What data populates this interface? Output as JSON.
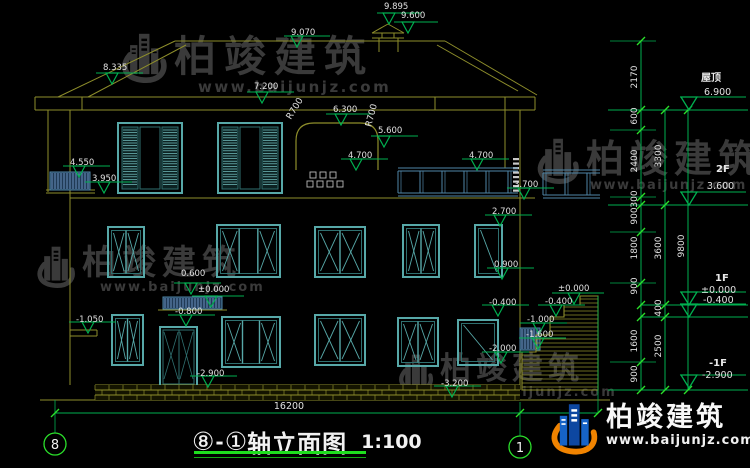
{
  "page": {
    "background": "#000000"
  },
  "colors": {
    "outline": "#8e8e2b",
    "window": "#57a8a8",
    "window_dim": "#2f6f6f",
    "railing": "#4f86a8",
    "hatch_fill": "#203a55",
    "hatch_stripe": "#7aa6d8",
    "dimension": "#00b050",
    "tick": "#2be02b",
    "underline": "#1ede1e",
    "text": "#e0e0e0",
    "watermark": "#3a3a3a",
    "logo_blue": "#1663c7",
    "logo_blue_dark": "#0d47a1",
    "logo_orange": "#f08300"
  },
  "brand": {
    "name": "柏竣建筑",
    "url": "www.baijunjz.com"
  },
  "title_block": {
    "axis_from": "⑧",
    "separator": "-",
    "axis_to": "①",
    "name": "轴立面图",
    "scale": "1:100"
  },
  "axis_bubbles": {
    "left": "8",
    "right": "1"
  },
  "overall_dimension": "16200",
  "elevation_markers": [
    {
      "t": "9.895",
      "x": 384,
      "y": 9,
      "tipx": 389,
      "tipy": 24,
      "l1": 377,
      "l2": 421
    },
    {
      "t": "9.600",
      "x": 401,
      "y": 18,
      "tipx": 408,
      "tipy": 33,
      "l1": 394,
      "l2": 438
    },
    {
      "t": "9.070",
      "x": 291,
      "y": 35,
      "tipx": 297,
      "tipy": 47,
      "l1": 284,
      "l2": 330
    },
    {
      "t": "8.335",
      "x": 103,
      "y": 70,
      "tipx": 112,
      "tipy": 84,
      "l1": 96,
      "l2": 143
    },
    {
      "t": "7.200",
      "x": 254,
      "y": 89,
      "tipx": 262,
      "tipy": 103,
      "l1": 247,
      "l2": 294
    },
    {
      "t": "6.300",
      "x": 333,
      "y": 112,
      "tipx": 341,
      "tipy": 125,
      "l1": 326,
      "l2": 373
    },
    {
      "t": "5.600",
      "x": 378,
      "y": 133,
      "tipx": 384,
      "tipy": 147,
      "l1": 371,
      "l2": 418
    },
    {
      "t": "4.700",
      "x": 348,
      "y": 158,
      "tipx": 356,
      "tipy": 170,
      "l1": 341,
      "l2": 388
    },
    {
      "t": "4.700",
      "x": 469,
      "y": 158,
      "tipx": 477,
      "tipy": 170,
      "l1": 462,
      "l2": 509
    },
    {
      "t": "4.550",
      "x": 70,
      "y": 165,
      "tipx": 79,
      "tipy": 177,
      "l1": 63,
      "l2": 110
    },
    {
      "t": "3.950",
      "x": 92,
      "y": 181,
      "tipx": 104,
      "tipy": 193,
      "l1": 85,
      "l2": 132
    },
    {
      "t": "3.700",
      "x": 514,
      "y": 187,
      "tipx": 524,
      "tipy": 199,
      "l1": 507,
      "l2": 554
    },
    {
      "t": "2.700",
      "x": 492,
      "y": 214,
      "tipx": 500,
      "tipy": 226,
      "l1": 485,
      "l2": 532
    },
    {
      "t": "0.900",
      "x": 494,
      "y": 267,
      "tipx": 502,
      "tipy": 279,
      "l1": 487,
      "l2": 534
    },
    {
      "t": "0.600",
      "x": 181,
      "y": 276,
      "tipx": 191,
      "tipy": 294,
      "l1": 174,
      "l2": 221
    },
    {
      "t": "±0.000",
      "x": 198,
      "y": 292,
      "tipx": 211,
      "tipy": 307,
      "l1": 192,
      "l2": 244
    },
    {
      "t": "-0.800",
      "x": 175,
      "y": 314,
      "tipx": 186,
      "tipy": 326,
      "l1": 168,
      "l2": 215
    },
    {
      "t": "-1.050",
      "x": 76,
      "y": 322,
      "tipx": 88,
      "tipy": 333,
      "l1": 69,
      "l2": 116
    },
    {
      "t": "-2.900",
      "x": 197,
      "y": 376,
      "tipx": 208,
      "tipy": 387,
      "l1": 190,
      "l2": 237
    },
    {
      "t": "-0.400",
      "x": 489,
      "y": 305,
      "tipx": 498,
      "tipy": 316,
      "l1": 482,
      "l2": 529
    },
    {
      "t": "±0.000",
      "x": 558,
      "y": 291,
      "tipx": 574,
      "tipy": 304,
      "l1": 552,
      "l2": 604
    },
    {
      "t": "-0.400",
      "x": 545,
      "y": 304,
      "tipx": 556,
      "tipy": 316,
      "l1": 538,
      "l2": 585
    },
    {
      "t": "-1.000",
      "x": 527,
      "y": 322,
      "tipx": 539,
      "tipy": 334,
      "l1": 520,
      "l2": 567
    },
    {
      "t": "-1.600",
      "x": 526,
      "y": 337,
      "tipx": 538,
      "tipy": 349,
      "l1": 519,
      "l2": 566
    },
    {
      "t": "-2.000",
      "x": 489,
      "y": 351,
      "tipx": 501,
      "tipy": 363,
      "l1": 482,
      "l2": 529
    },
    {
      "t": "-3.200",
      "x": 441,
      "y": 386,
      "tipx": 452,
      "tipy": 397,
      "l1": 434,
      "l2": 481
    }
  ],
  "right_levels": [
    {
      "label": "屋顶",
      "lx": 701,
      "ly": 81,
      "value": "6.900",
      "vx": 704,
      "vy": 95,
      "tipy": 110
    },
    {
      "label": "2F",
      "lx": 716,
      "ly": 172,
      "value": "3.600",
      "vx": 707,
      "vy": 189,
      "tipy": 205
    },
    {
      "label": "1F",
      "lx": 715,
      "ly": 281,
      "value": "±0.000",
      "vx": 701,
      "vy": 293,
      "tipy": 305
    },
    {
      "label": "",
      "lx": 0,
      "ly": 0,
      "value": "-0.400",
      "vx": 703,
      "vy": 303,
      "tipy": 317
    },
    {
      "label": "-1F",
      "lx": 709,
      "ly": 366,
      "value": "-2.900",
      "vx": 702,
      "vy": 378,
      "tipy": 388
    }
  ],
  "dim_chains": [
    {
      "x": 637,
      "labels": [
        {
          "t": "2170",
          "y": 77
        },
        {
          "t": "600",
          "y": 116
        },
        {
          "t": "2400",
          "y": 161
        },
        {
          "t": "300",
          "y": 199
        },
        {
          "t": "900",
          "y": 216
        },
        {
          "t": "1800",
          "y": 248
        },
        {
          "t": "900",
          "y": 286
        },
        {
          "t": "1600",
          "y": 341
        },
        {
          "t": "900",
          "y": 374
        }
      ]
    },
    {
      "x": 661,
      "labels": [
        {
          "t": "3300",
          "y": 156
        },
        {
          "t": "3600",
          "y": 248
        },
        {
          "t": "400",
          "y": 308
        },
        {
          "t": "2500",
          "y": 346
        }
      ]
    },
    {
      "x": 684,
      "labels": [
        {
          "t": "9800",
          "y": 246
        }
      ]
    }
  ],
  "radius_labels": [
    {
      "t": "R700",
      "x": 297,
      "y": 110,
      "rot": -58
    },
    {
      "t": "R700",
      "x": 374,
      "y": 116,
      "rot": -75
    }
  ]
}
